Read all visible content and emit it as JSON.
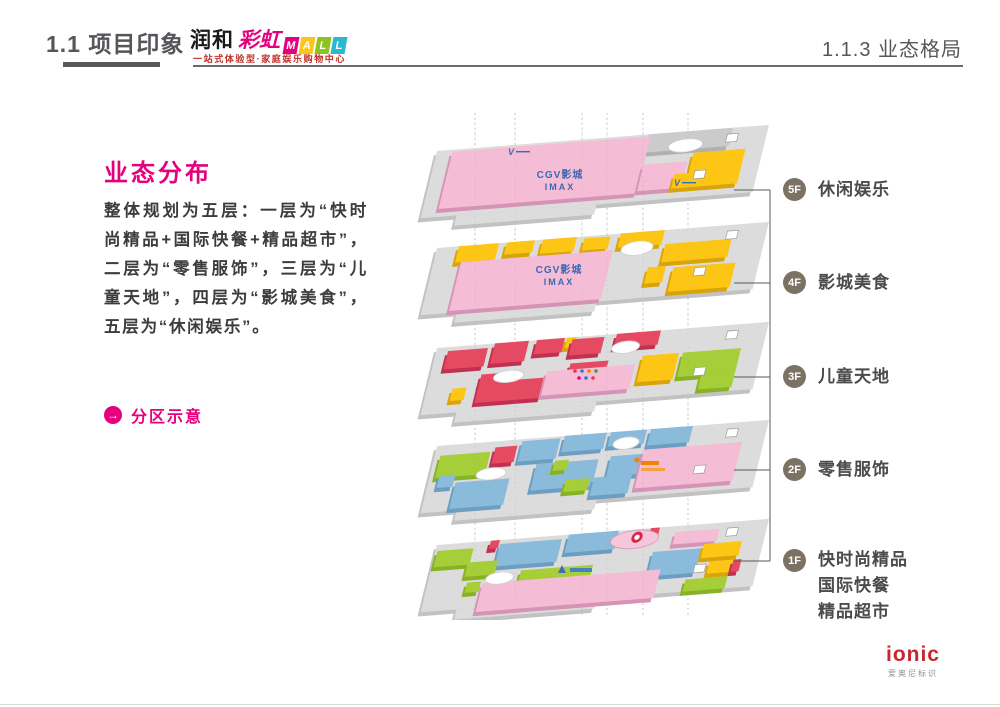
{
  "header": {
    "section_title": "1.1 项目印象",
    "logo_cn_1": "润和",
    "logo_cn_2": "彩虹",
    "logo_tiles": [
      "M",
      "A",
      "L",
      "L"
    ],
    "logo_tagline": "一站式体验型·家庭娱乐购物中心",
    "page_title": "1.1.3 业态格局"
  },
  "left_panel": {
    "heading": "业态分布",
    "paragraph": "整体规划为五层：一层为“快时尚精品+国际快餐+精品超市”，二层为“零售服饰”，三层为“儿童天地”，四层为“影城美食”，五层为“休闲娱乐”。",
    "link_arrow": "→",
    "link_label": "分区示意"
  },
  "diagram": {
    "cinema_line1": "CGV影城",
    "cinema_line2": "IMAX",
    "v_mark": "V",
    "floor_labels": [
      {
        "id": "5F",
        "lines": [
          "休闲娱乐"
        ]
      },
      {
        "id": "4F",
        "lines": [
          "影城美食"
        ]
      },
      {
        "id": "3F",
        "lines": [
          "儿童天地"
        ]
      },
      {
        "id": "2F",
        "lines": [
          "零售服饰"
        ]
      },
      {
        "id": "1F",
        "lines": [
          "快时尚精品",
          "国际快餐",
          "精品超市"
        ]
      }
    ]
  },
  "footer": {
    "brand": "ionic",
    "brand_sub": "爱奥尼标识"
  },
  "colors": {
    "accent": "#e5007d",
    "pink": "#f4bcd5",
    "yellow": "#fdc514",
    "red": "#e64a62",
    "blue": "#8abbdb",
    "green": "#a5ce39",
    "plate": "#dcdcdc",
    "label_circle": "#7b7264",
    "cgv_blue": "#3a6ab5",
    "logo_tile_colors": [
      "#e5007d",
      "#fdc514",
      "#8cc320",
      "#29b8ce"
    ]
  }
}
